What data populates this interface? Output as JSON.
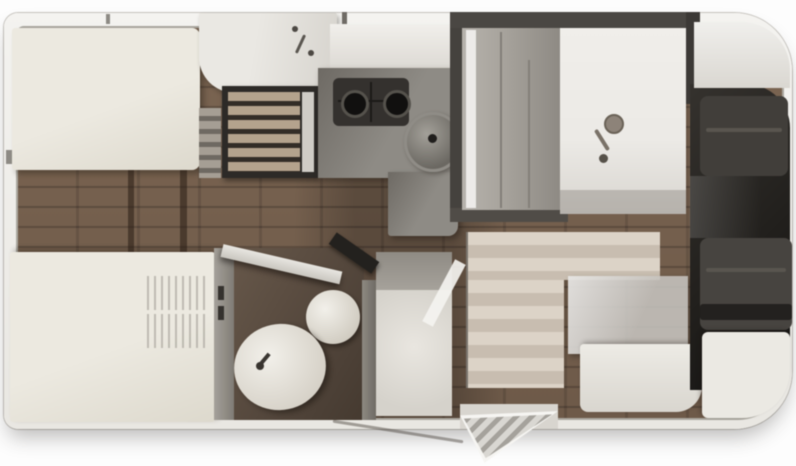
{
  "diagram": {
    "type": "motorhome-floorplan-top-view",
    "title": "Motorhome floor plan — top view, cab at right, rear at left",
    "orientation": {
      "front": "right",
      "rear": "left"
    },
    "rooms": {
      "plan": {
        "label": "Motorhome floor plan (top view)"
      },
      "rear_bed_top": {
        "label": "Rear single bed (upper side)"
      },
      "rear_bed_bottom": {
        "label": "Rear single bed (lower side)"
      },
      "rear_steps": {
        "label": "Steps between rear twin beds",
        "count": 2
      },
      "vanity": {
        "label": "Washbasin vanity unit with tap"
      },
      "cabinet": {
        "label": "Slatted cabinet / refrigerator tower"
      },
      "kitchen": {
        "label": "L-shaped kitchen with hob and round sink",
        "burners": 2,
        "sink": "round"
      },
      "washroom": {
        "label": "Washroom with shower head and floor drain"
      },
      "bathroom": {
        "label": "Bathroom with toilet and oval washbasin",
        "door": "open diagonal"
      },
      "shower_cabin": {
        "label": "Shower cabin with tray"
      },
      "entry": {
        "label": "Entrance door with fold-out step and striped mat"
      },
      "dinette": {
        "label": "Dinette with table and bench seat"
      },
      "cab": {
        "label": "Driver cab with two seats and dashboard",
        "seats": 2
      }
    },
    "icons": [
      "shower-head-icon",
      "drain-icon",
      "faucet-icon",
      "hob-burner-icon",
      "sink-icon",
      "toilet-icon",
      "washbasin-icon",
      "entry-step-icon"
    ],
    "colors": {
      "body-exterior": "#f4f3f0",
      "wall-line": "#aaa79f",
      "wood-base": "#7c6551",
      "wood-dark": "#5d4a3b",
      "bed-ivory": "#ece9e0",
      "cabinet-dark": "#2d2a27",
      "slat-tan": "#b5a38c",
      "counter-gray": "#8e8b85",
      "hob-dark": "#34312e",
      "room-wall": "#45423e",
      "room-gray": "#a8a49d",
      "panel-white": "#eceae6",
      "bath-floor": "#55483c",
      "fixture-white": "#f2f0ea",
      "cab-dark": "#22201d",
      "seat-gray": "#413e3a",
      "bench-ivory": "#d9d6cf",
      "mat-a": "#dcd3c6",
      "mat-b": "#c8bdaf",
      "table-gray": "#c5c3be",
      "step-gray": "#a5a29c"
    }
  }
}
